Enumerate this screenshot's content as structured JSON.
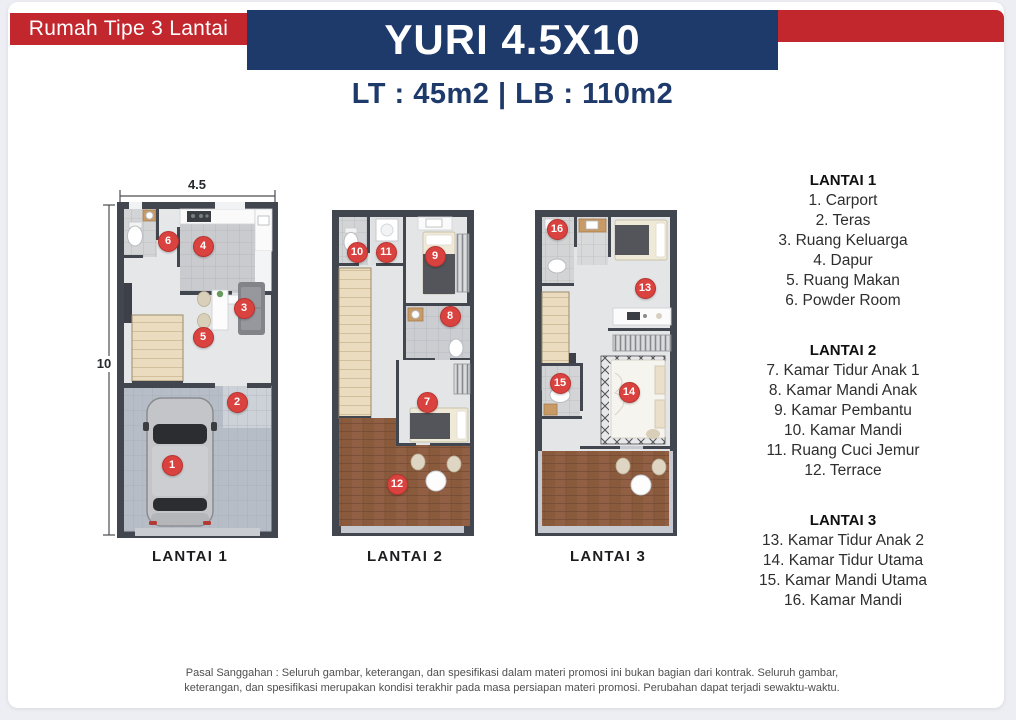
{
  "header": {
    "badge": "Rumah Tipe 3 Lantai",
    "title": "YURI 4.5X10",
    "subtitle": "LT : 45m2 | LB : 110m2"
  },
  "dimensions": {
    "width": "4.5",
    "depth": "10"
  },
  "plans": [
    {
      "label": "LANTAI 1"
    },
    {
      "label": "LANTAI 2"
    },
    {
      "label": "LANTAI 3"
    }
  ],
  "legend": [
    {
      "header": "LANTAI 1",
      "items": [
        "1. Carport",
        "2. Teras",
        "3. Ruang Keluarga",
        "4. Dapur",
        "5. Ruang Makan",
        "6. Powder Room"
      ]
    },
    {
      "header": "LANTAI 2",
      "items": [
        "7. Kamar Tidur Anak 1",
        "8. Kamar Mandi Anak",
        "9. Kamar Pembantu",
        "10. Kamar Mandi",
        "11. Ruang Cuci Jemur",
        "12. Terrace"
      ]
    },
    {
      "header": "LANTAI 3",
      "items": [
        "13. Kamar Tidur Anak 2",
        "14. Kamar Tidur Utama",
        "15. Kamar Mandi Utama",
        "16. Kamar Mandi"
      ]
    }
  ],
  "markers": [
    {
      "n": "1",
      "x": 172,
      "y": 465
    },
    {
      "n": "2",
      "x": 237,
      "y": 402
    },
    {
      "n": "3",
      "x": 244,
      "y": 308
    },
    {
      "n": "4",
      "x": 203,
      "y": 246
    },
    {
      "n": "5",
      "x": 203,
      "y": 337
    },
    {
      "n": "6",
      "x": 168,
      "y": 241
    },
    {
      "n": "7",
      "x": 427,
      "y": 402
    },
    {
      "n": "8",
      "x": 450,
      "y": 316
    },
    {
      "n": "9",
      "x": 435,
      "y": 256
    },
    {
      "n": "10",
      "x": 357,
      "y": 252
    },
    {
      "n": "11",
      "x": 386,
      "y": 252
    },
    {
      "n": "12",
      "x": 397,
      "y": 484
    },
    {
      "n": "13",
      "x": 645,
      "y": 288
    },
    {
      "n": "14",
      "x": 629,
      "y": 392
    },
    {
      "n": "15",
      "x": 560,
      "y": 383
    },
    {
      "n": "16",
      "x": 557,
      "y": 229
    }
  ],
  "disclaimer": "Pasal Sanggahan : Seluruh gambar, keterangan, dan spesifikasi dalam materi promosi ini bukan bagian dari kontrak. Seluruh gambar, keterangan, dan spesifikasi merupakan kondisi terakhir pada masa persiapan materi promosi. Perubahan dapat terjadi sewaktu-waktu.",
  "colors": {
    "red": "#c1272d",
    "navy": "#1e3a6b",
    "marker_red": "#d9423e"
  }
}
